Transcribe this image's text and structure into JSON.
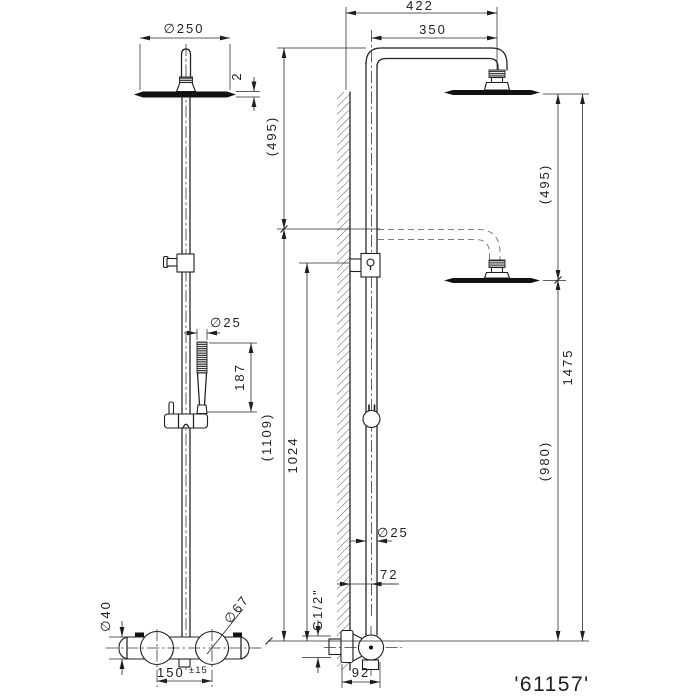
{
  "drawing": {
    "background": "#ffffff",
    "ink_color": "#1f1f1f",
    "code": "'61157'",
    "front_view": {
      "head_diameter": "∅250",
      "head_thickness": "2",
      "handshower_diameter": "∅25",
      "handshower_length": "187",
      "body_diameter": "∅40",
      "handle_diameter": "∅67",
      "inlet_spacing": "150",
      "inlet_spacing_tol": "±15"
    },
    "side_view": {
      "reach_overall": "422",
      "arm_reach": "350",
      "drop_left": "(495)",
      "drop_right": "(495)",
      "height_total": "1475",
      "height_rail": "(1109)",
      "height_bracket": "1024",
      "height_lower": "(980)",
      "pipe_diameter": "∅25",
      "wall_to_pipe": "72",
      "thread": "G1/2\"",
      "wall_to_handle": "92"
    }
  }
}
